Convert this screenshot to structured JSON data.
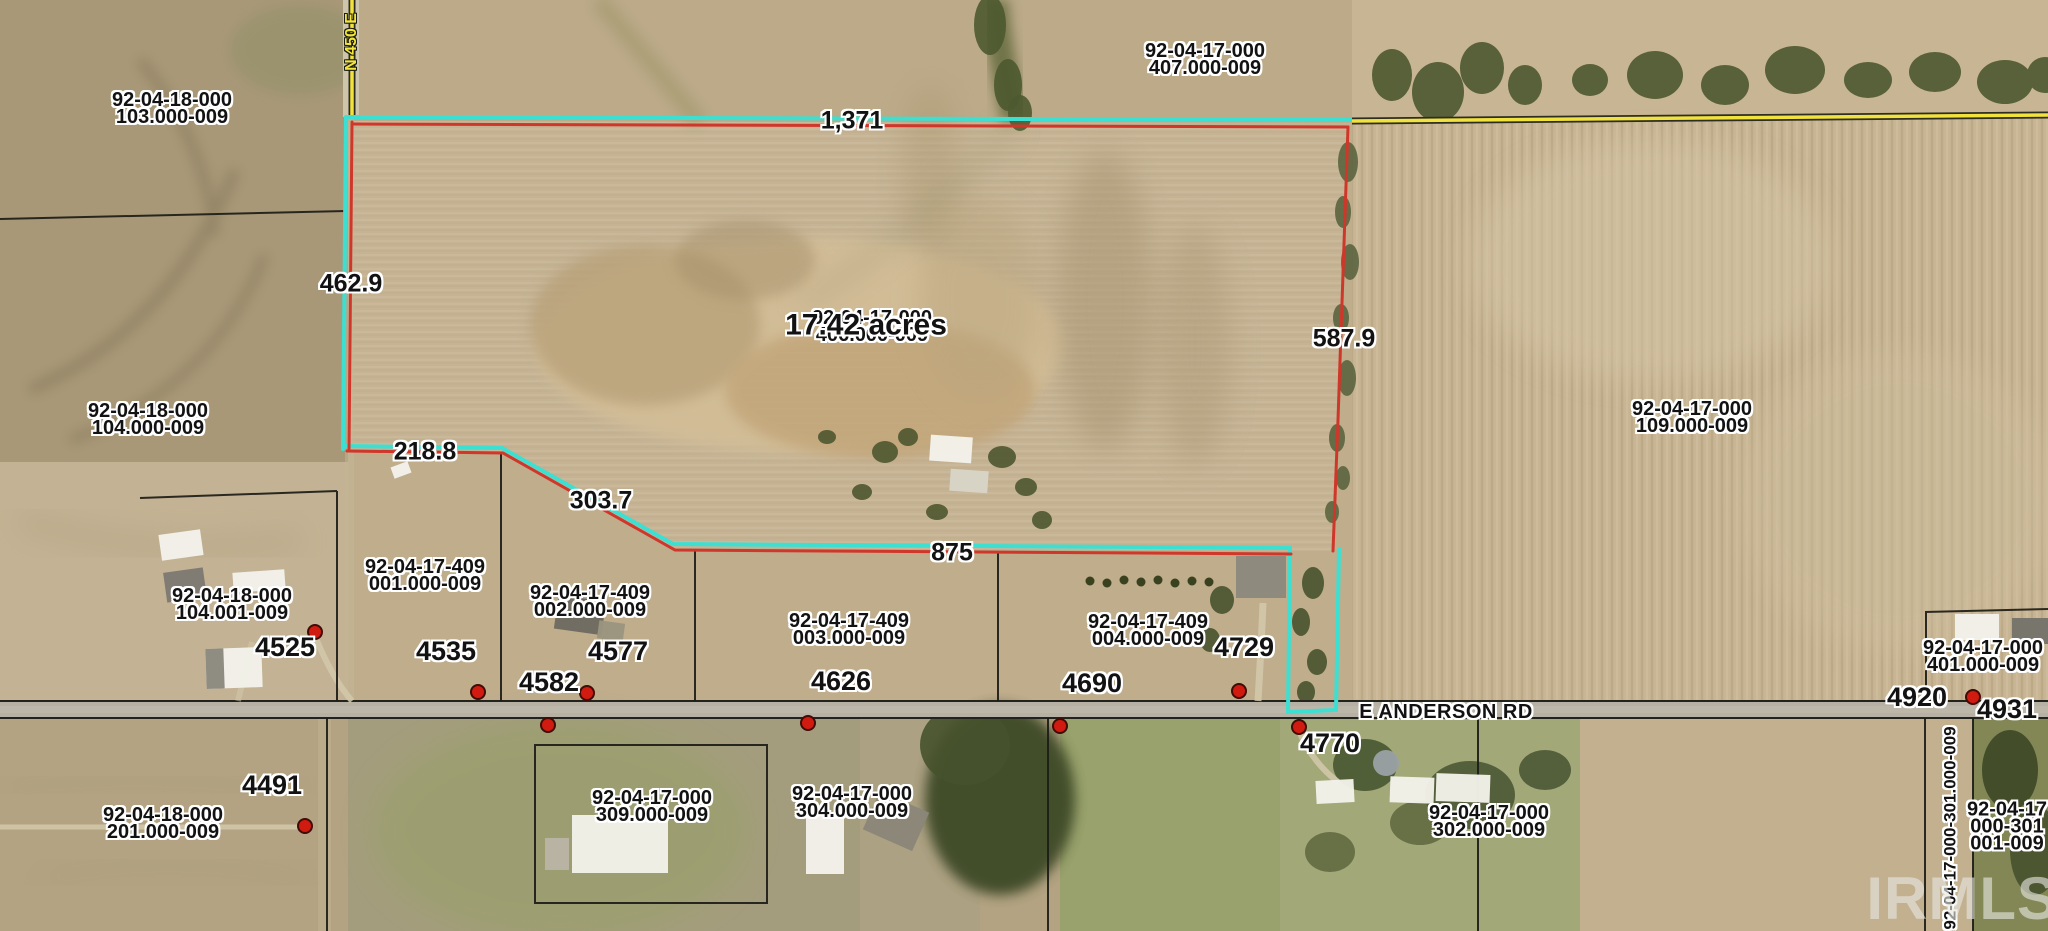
{
  "watermark": "IRMLS",
  "roads": {
    "east_west": "E ANDERSON RD",
    "north_south": "N 450 E"
  },
  "subject_parcel": {
    "apn_line1": "92-04-17-000",
    "apn_line2": "406.000-009",
    "acreage": "17.42 acres",
    "boundary_color": "#3be0d2",
    "inner_boundary_color": "#ce372a",
    "dimensions": {
      "north": "1,371",
      "west": "462.9",
      "south_a": "218.8",
      "south_b": "303.7",
      "south_c": "875",
      "east": "587.9"
    }
  },
  "parcel_labels": [
    {
      "line1": "92-04-18-000",
      "line2": "103.000-009"
    },
    {
      "line1": "92-04-17-000",
      "line2": "407.000-009"
    },
    {
      "line1": "92-04-18-000",
      "line2": "104.000-009"
    },
    {
      "line1": "92-04-17-000",
      "line2": "109.000-009"
    },
    {
      "line1": "92-04-18-000",
      "line2": "104.001-009"
    },
    {
      "line1": "92-04-17-409",
      "line2": "001.000-009"
    },
    {
      "line1": "92-04-17-409",
      "line2": "002.000-009"
    },
    {
      "line1": "92-04-17-409",
      "line2": "003.000-009"
    },
    {
      "line1": "92-04-17-409",
      "line2": "004.000-009"
    },
    {
      "line1": "92-04-17-000",
      "line2": "401.000-009"
    },
    {
      "line1": "92-04-18-000",
      "line2": "201.000-009"
    },
    {
      "line1": "92-04-17-000",
      "line2": "309.000-009"
    },
    {
      "line1": "92-04-17-000",
      "line2": "304.000-009"
    },
    {
      "line1": "92-04-17-000",
      "line2": "302.000-009"
    },
    {
      "line1": "92-04-17",
      "line2": "000-301",
      "line3": "001-009"
    }
  ],
  "rotated_parcel_label": "92-04-17-000-301.000-009",
  "addresses": [
    "4525",
    "4535",
    "4577",
    "4582",
    "4626",
    "4690",
    "4729",
    "4770",
    "4491",
    "4920",
    "4931"
  ],
  "marker_color": "#d11b10"
}
